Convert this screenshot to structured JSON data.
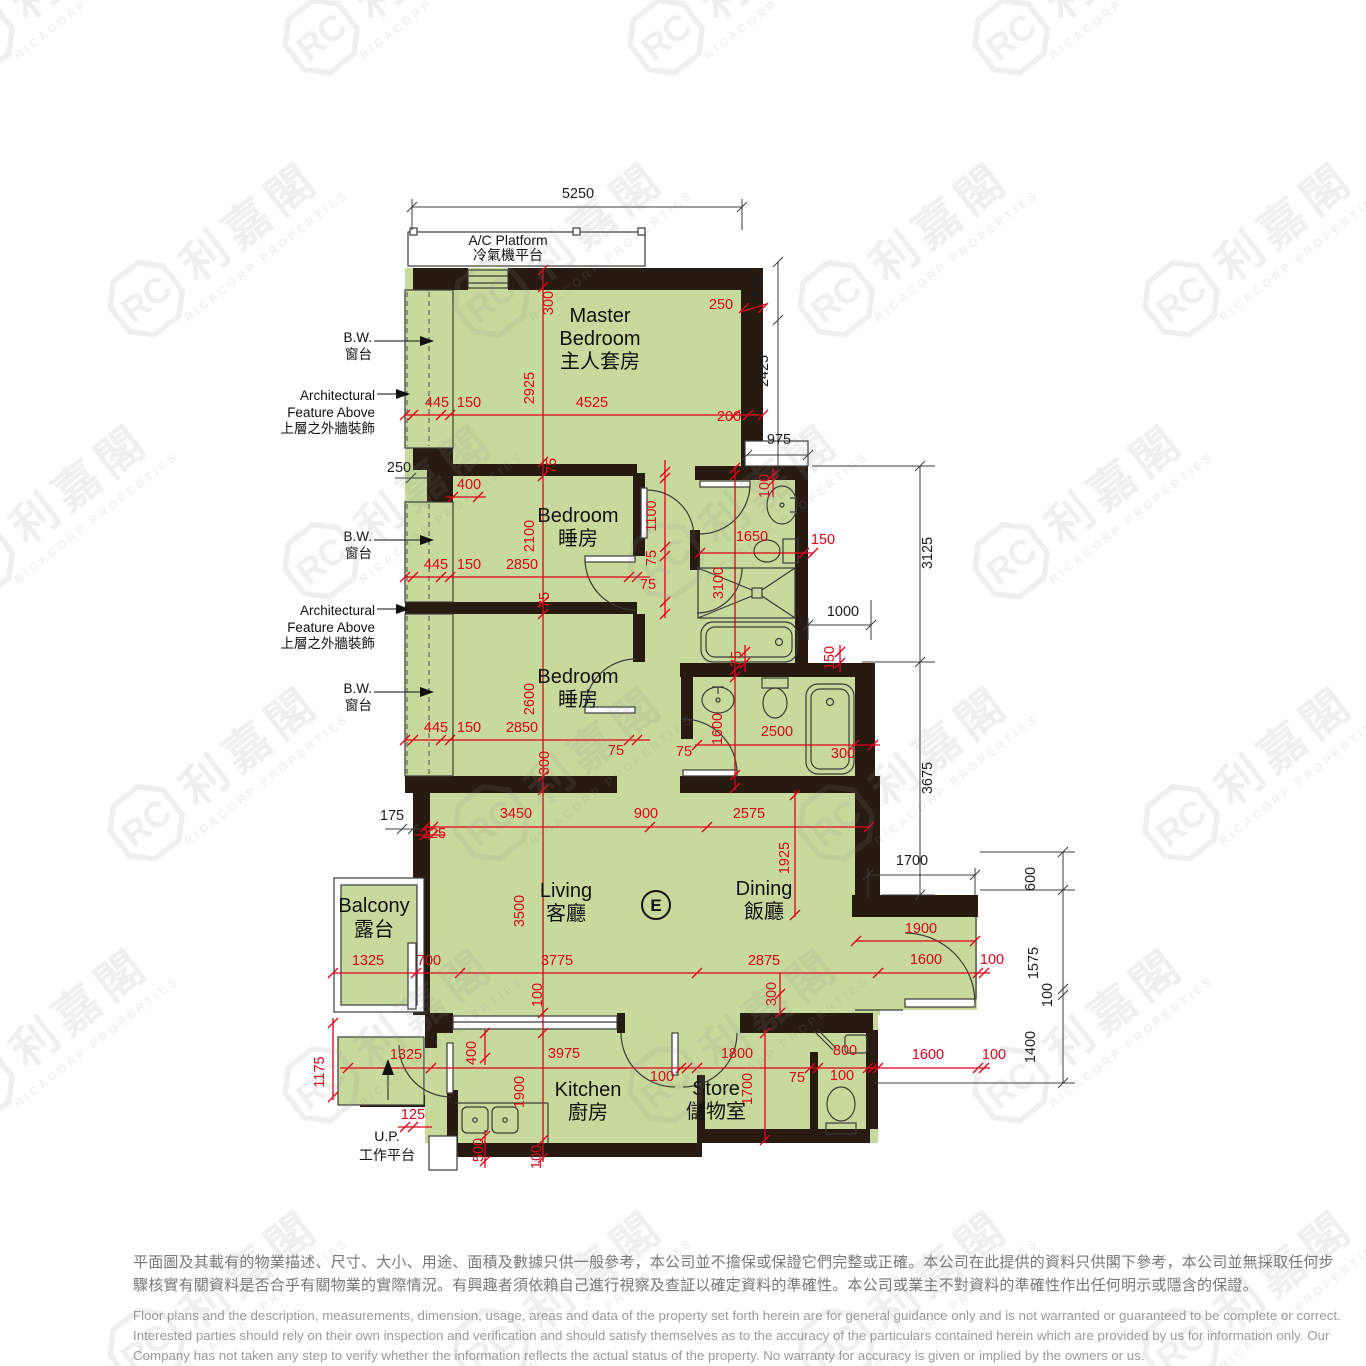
{
  "watermark": {
    "cjk": "利嘉閣",
    "latin": "RICACORP PROPERTIES",
    "monogram": "RC"
  },
  "unit_mark": "E",
  "rooms": [
    {
      "id": "ac-platform",
      "lines": [
        "A/C Platform",
        "冷氣機平台"
      ],
      "x": 508,
      "y": 245,
      "small": true,
      "dy": 15
    },
    {
      "id": "master-bedroom",
      "lines": [
        "Master",
        "Bedroom",
        "主人套房"
      ],
      "x": 600,
      "y": 322,
      "dy": 23
    },
    {
      "id": "bedroom-1",
      "lines": [
        "Bedroom",
        "睡房"
      ],
      "x": 578,
      "y": 522,
      "dy": 23
    },
    {
      "id": "bedroom-2",
      "lines": [
        "Bedroom",
        "睡房"
      ],
      "x": 578,
      "y": 683,
      "dy": 23
    },
    {
      "id": "living",
      "lines": [
        "Living",
        "客廳"
      ],
      "x": 566,
      "y": 897,
      "dy": 23
    },
    {
      "id": "dining",
      "lines": [
        "Dining",
        "飯廳"
      ],
      "x": 764,
      "y": 895,
      "dy": 23
    },
    {
      "id": "balcony",
      "lines": [
        "Balcony",
        "露台"
      ],
      "x": 374,
      "y": 912,
      "dy": 24
    },
    {
      "id": "kitchen",
      "lines": [
        "Kitchen",
        "廚房"
      ],
      "x": 588,
      "y": 1096,
      "dy": 23
    },
    {
      "id": "store",
      "lines": [
        "Store",
        "儲物室"
      ],
      "x": 716,
      "y": 1095,
      "dy": 23
    },
    {
      "id": "up",
      "lines": [
        "U.P.",
        "工作平台"
      ],
      "x": 387,
      "y": 1141,
      "small": true,
      "dy": 19
    }
  ],
  "annotations": [
    {
      "id": "bw-1",
      "lines": [
        "B.W.",
        "窗台"
      ]
    },
    {
      "id": "af-1",
      "lines": [
        "Architectural",
        "Feature Above",
        "上層之外牆裝飾"
      ]
    },
    {
      "id": "bw-2",
      "lines": [
        "B.W.",
        "窗台"
      ]
    },
    {
      "id": "af-2",
      "lines": [
        "Architectural",
        "Feature Above",
        "上層之外牆裝飾"
      ]
    },
    {
      "id": "bw-3",
      "lines": [
        "B.W.",
        "窗台"
      ]
    }
  ],
  "dims_red": [
    {
      "t": "300",
      "x": 553,
      "y": 303,
      "r": -90
    },
    {
      "t": "2925",
      "x": 534,
      "y": 388,
      "r": -90
    },
    {
      "t": "4525",
      "x": 592,
      "y": 407
    },
    {
      "t": "445",
      "x": 437,
      "y": 407
    },
    {
      "t": "150",
      "x": 469,
      "y": 407
    },
    {
      "t": "250",
      "x": 721,
      "y": 309
    },
    {
      "t": "200",
      "x": 729,
      "y": 421
    },
    {
      "t": "75",
      "x": 556,
      "y": 466,
      "r": -90
    },
    {
      "t": "400",
      "x": 469,
      "y": 489
    },
    {
      "t": "2100",
      "x": 534,
      "y": 536,
      "r": -90
    },
    {
      "t": "1100",
      "x": 656,
      "y": 516,
      "r": -90
    },
    {
      "t": "75",
      "x": 656,
      "y": 558,
      "r": -90
    },
    {
      "t": "445",
      "x": 436,
      "y": 569
    },
    {
      "t": "150",
      "x": 469,
      "y": 569
    },
    {
      "t": "2850",
      "x": 522,
      "y": 569
    },
    {
      "t": "75",
      "x": 648,
      "y": 589
    },
    {
      "t": "75",
      "x": 549,
      "y": 600,
      "r": -90
    },
    {
      "t": "100",
      "x": 769,
      "y": 486,
      "r": -90
    },
    {
      "t": "1650",
      "x": 752,
      "y": 541
    },
    {
      "t": "150",
      "x": 823,
      "y": 544
    },
    {
      "t": "3100",
      "x": 723,
      "y": 583,
      "r": -90
    },
    {
      "t": "75",
      "x": 741,
      "y": 659,
      "r": -90
    },
    {
      "t": "150",
      "x": 834,
      "y": 658,
      "r": -90
    },
    {
      "t": "2600",
      "x": 534,
      "y": 699,
      "r": -90
    },
    {
      "t": "445",
      "x": 436,
      "y": 732
    },
    {
      "t": "150",
      "x": 469,
      "y": 732
    },
    {
      "t": "2850",
      "x": 522,
      "y": 732
    },
    {
      "t": "75",
      "x": 616,
      "y": 755
    },
    {
      "t": "75",
      "x": 684,
      "y": 756
    },
    {
      "t": "300",
      "x": 549,
      "y": 763,
      "r": -90
    },
    {
      "t": "1600",
      "x": 722,
      "y": 729,
      "r": -90
    },
    {
      "t": "2500",
      "x": 777,
      "y": 736
    },
    {
      "t": "300",
      "x": 843,
      "y": 758
    },
    {
      "t": "125",
      "x": 434,
      "y": 838
    },
    {
      "t": "3450",
      "x": 516,
      "y": 818
    },
    {
      "t": "900",
      "x": 646,
      "y": 818
    },
    {
      "t": "2575",
      "x": 749,
      "y": 818
    },
    {
      "t": "1925",
      "x": 789,
      "y": 858,
      "r": -90
    },
    {
      "t": "3500",
      "x": 524,
      "y": 911,
      "r": -90
    },
    {
      "t": "1900",
      "x": 921,
      "y": 933
    },
    {
      "t": "1325",
      "x": 368,
      "y": 965
    },
    {
      "t": "700",
      "x": 429,
      "y": 965
    },
    {
      "t": "3775",
      "x": 557,
      "y": 965
    },
    {
      "t": "2875",
      "x": 764,
      "y": 965
    },
    {
      "t": "1600",
      "x": 926,
      "y": 964
    },
    {
      "t": "100",
      "x": 992,
      "y": 964
    },
    {
      "t": "100",
      "x": 542,
      "y": 995,
      "r": -90
    },
    {
      "t": "300",
      "x": 776,
      "y": 994,
      "r": -90
    },
    {
      "t": "1175",
      "x": 324,
      "y": 1072,
      "r": -90
    },
    {
      "t": "1325",
      "x": 406,
      "y": 1059
    },
    {
      "t": "400",
      "x": 476,
      "y": 1053,
      "r": -90
    },
    {
      "t": "3975",
      "x": 564,
      "y": 1058
    },
    {
      "t": "100",
      "x": 662,
      "y": 1081
    },
    {
      "t": "1800",
      "x": 737,
      "y": 1058
    },
    {
      "t": "800",
      "x": 845,
      "y": 1055
    },
    {
      "t": "75",
      "x": 797,
      "y": 1082
    },
    {
      "t": "100",
      "x": 842,
      "y": 1080
    },
    {
      "t": "1600",
      "x": 928,
      "y": 1059
    },
    {
      "t": "100",
      "x": 994,
      "y": 1059
    },
    {
      "t": "1900",
      "x": 524,
      "y": 1092,
      "r": -90
    },
    {
      "t": "1700",
      "x": 752,
      "y": 1089,
      "r": -90
    },
    {
      "t": "125",
      "x": 413,
      "y": 1119
    },
    {
      "t": "500",
      "x": 483,
      "y": 1150,
      "r": -90
    },
    {
      "t": "100",
      "x": 541,
      "y": 1157,
      "r": -90
    }
  ],
  "dims_black": [
    {
      "t": "5250",
      "x": 578,
      "y": 198
    },
    {
      "t": "775",
      "x": 762,
      "y": 287,
      "r": -90
    },
    {
      "t": "2425",
      "x": 768,
      "y": 371,
      "r": -90
    },
    {
      "t": "975",
      "x": 779,
      "y": 444
    },
    {
      "t": "3125",
      "x": 932,
      "y": 553,
      "r": -90
    },
    {
      "t": "3675",
      "x": 932,
      "y": 778,
      "r": -90
    },
    {
      "t": "1000",
      "x": 843,
      "y": 616
    },
    {
      "t": "1700",
      "x": 912,
      "y": 865
    },
    {
      "t": "600",
      "x": 1035,
      "y": 879,
      "r": -90
    },
    {
      "t": "1575",
      "x": 1038,
      "y": 963,
      "r": -90
    },
    {
      "t": "100",
      "x": 1052,
      "y": 995,
      "r": -90
    },
    {
      "t": "1400",
      "x": 1035,
      "y": 1047,
      "r": -90
    },
    {
      "t": "250",
      "x": 399,
      "y": 472
    },
    {
      "t": "175",
      "x": 392,
      "y": 820
    }
  ],
  "disclaimer": {
    "zh": [
      "平面圖及其載有的物業描述、尺寸、大小、用途、面積及數據只供一般參考，本公司並不擔保或保證它們完整或正確。本公司在此提供的資料只供閣下參考，本公司並無採取任何步",
      "驟核實有關資料是否合乎有關物業的實際情況。有興趣者須依賴自己進行視察及查証以確定資料的準確性。本公司或業主不對資料的準確性作出任何明示或隱含的保證。"
    ],
    "en": [
      "Floor plans and the description, measurements, dimension, usage, areas and data of the property set forth herein are for general guidance only and is not warranted or guaranteed to be complete or correct.",
      "Interested parties should rely on their own inspection and verification and should satisfy themselves as to the accuracy of the particulars contained herein which are provided by us for information only.  Our",
      "Company has not taken any step to verify whether the information reflects the actual status of the property.  No warranty for accuracy is given or implied by the owners or us."
    ]
  }
}
